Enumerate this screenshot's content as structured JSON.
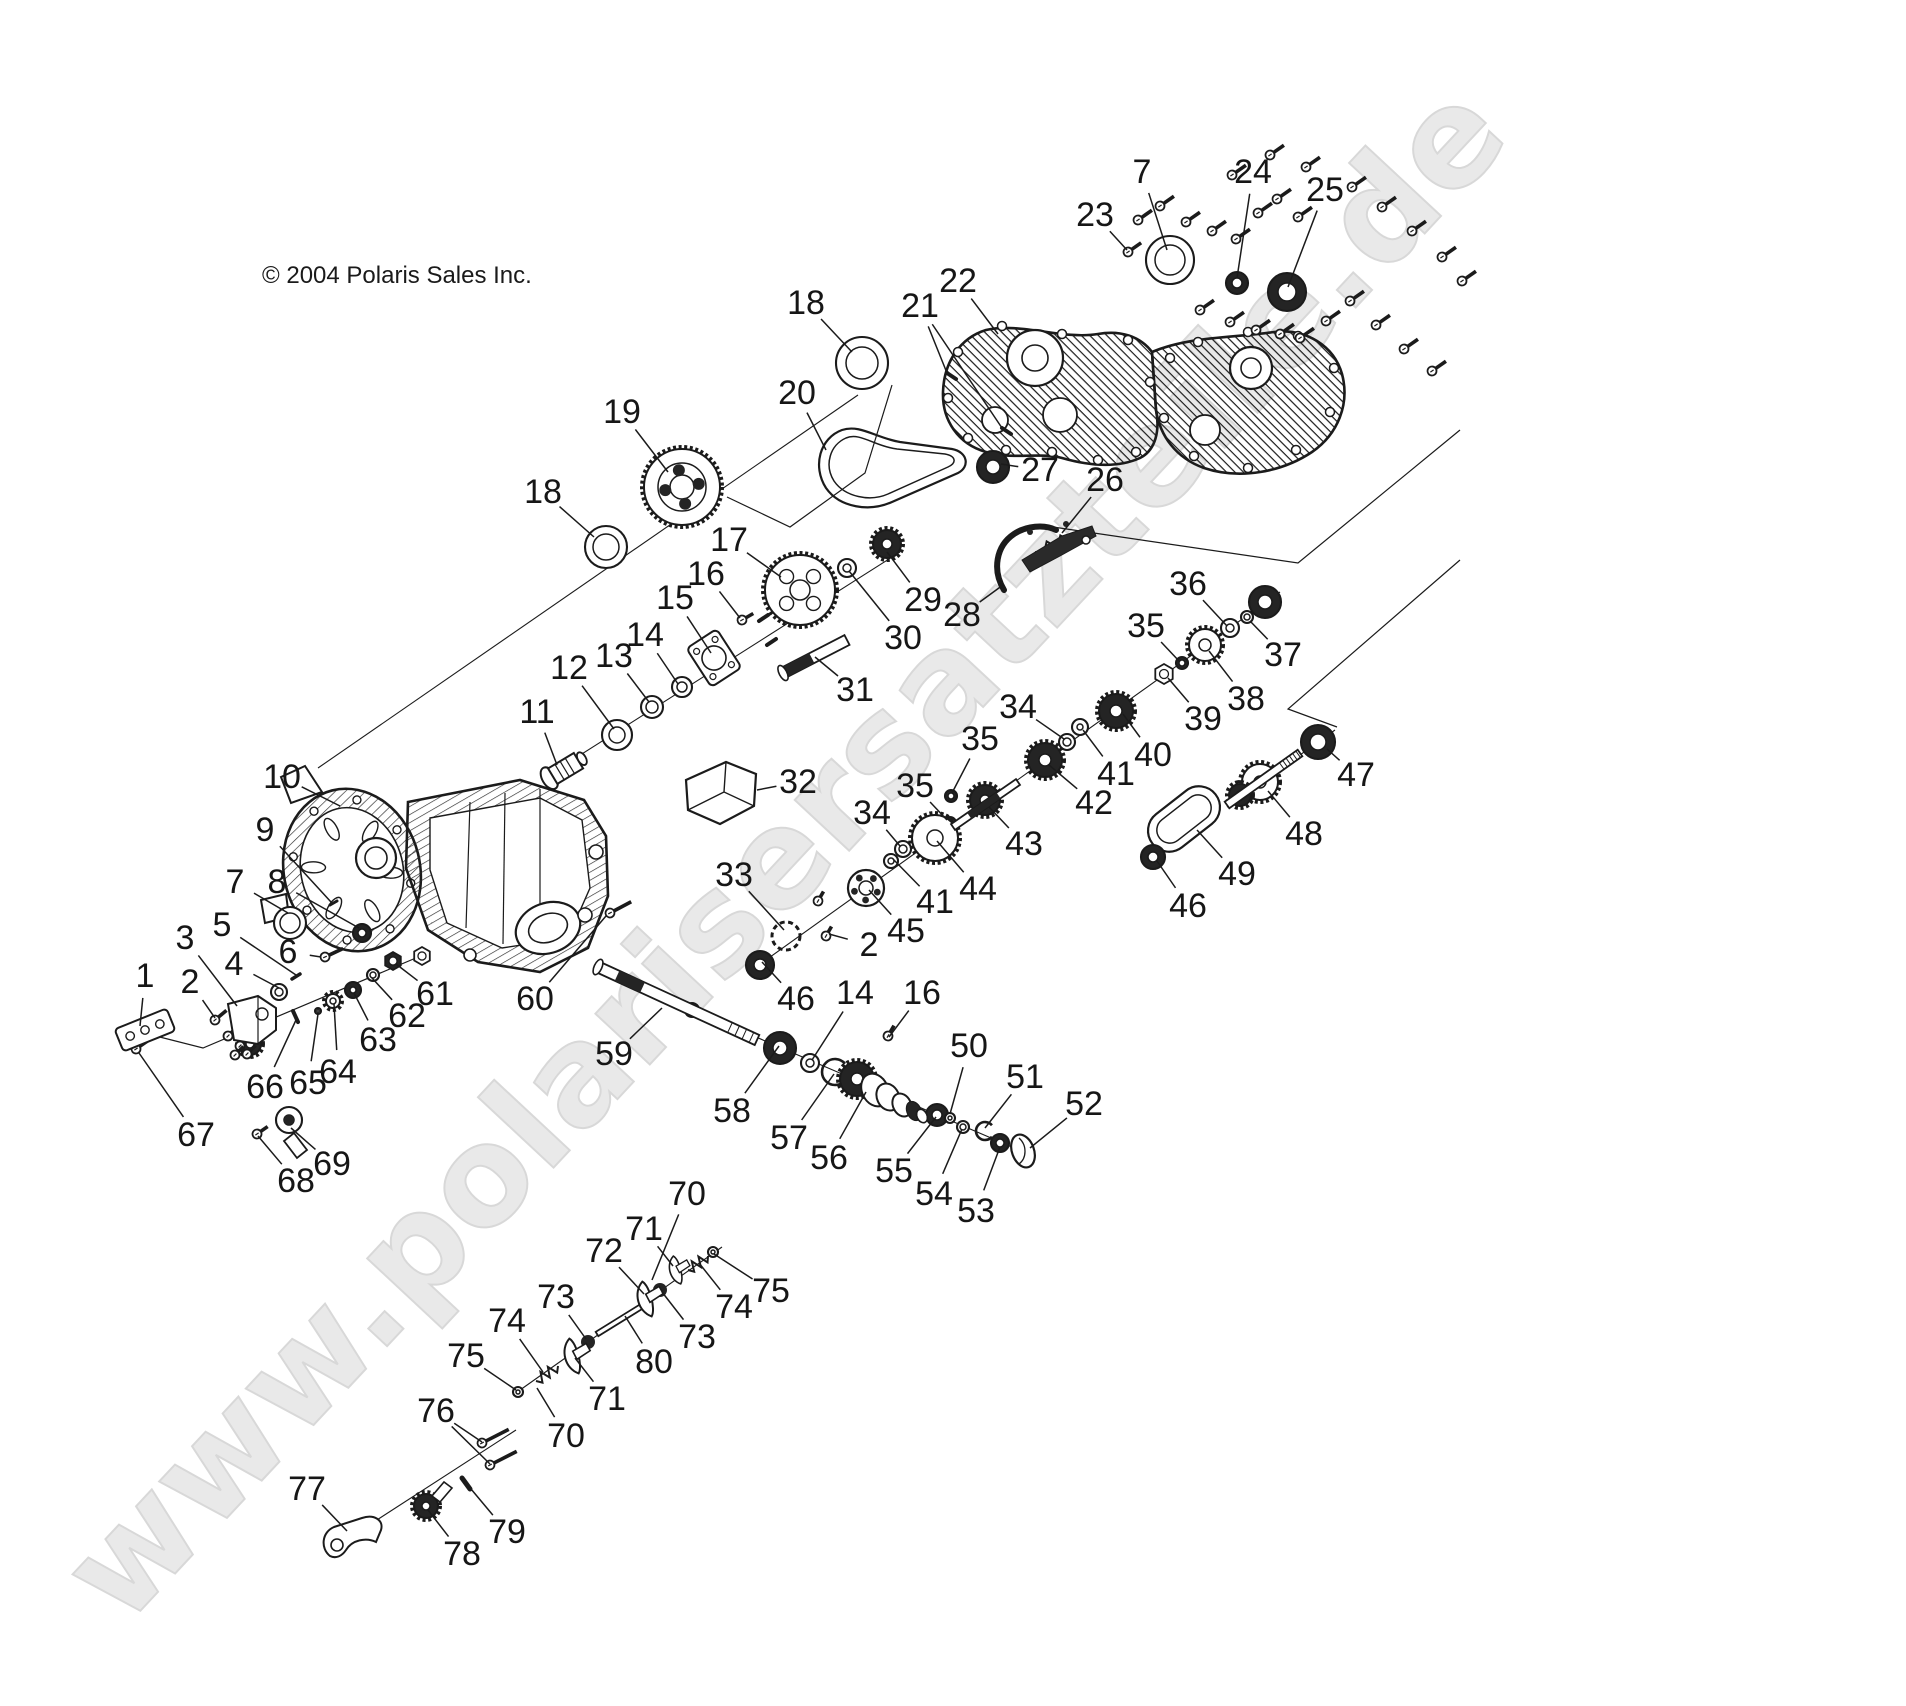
{
  "meta": {
    "copyright": "© 2004 Polaris Sales Inc.",
    "watermark": "www.polarisersatzteile.de",
    "line_color": "#1b1b1b",
    "watermark_color": "#e9e9e9"
  },
  "diagram": {
    "description": "Exploded parts diagram of a Polaris gearcase / transmission assembly",
    "callouts": [
      {
        "n": "1",
        "x": 145,
        "y": 976,
        "tx": 140,
        "ty": 1026
      },
      {
        "n": "2",
        "x": 190,
        "y": 982,
        "tx": 215,
        "ty": 1018
      },
      {
        "n": "3",
        "x": 185,
        "y": 938,
        "tx": 237,
        "ty": 1006
      },
      {
        "n": "4",
        "x": 234,
        "y": 964,
        "tx": 279,
        "ty": 988
      },
      {
        "n": "5",
        "x": 222,
        "y": 925,
        "tx": 296,
        "ty": 975
      },
      {
        "n": "6",
        "x": 288,
        "y": 952,
        "tx": 321,
        "ty": 957
      },
      {
        "n": "7",
        "x": 235,
        "y": 882,
        "tx": 288,
        "ty": 913
      },
      {
        "n": "8",
        "x": 277,
        "y": 882,
        "tx": 359,
        "ty": 928
      },
      {
        "n": "9",
        "x": 265,
        "y": 830,
        "tx": 331,
        "ty": 902
      },
      {
        "n": "10",
        "x": 282,
        "y": 777,
        "tx": 340,
        "ty": 806
      },
      {
        "n": "11",
        "x": 537,
        "y": 712,
        "tx": 557,
        "ty": 765
      },
      {
        "n": "12",
        "x": 569,
        "y": 668,
        "tx": 614,
        "ty": 729
      },
      {
        "n": "13",
        "x": 614,
        "y": 656,
        "tx": 649,
        "ty": 702
      },
      {
        "n": "14",
        "x": 645,
        "y": 635,
        "tx": 678,
        "ty": 684
      },
      {
        "n": "15",
        "x": 675,
        "y": 598,
        "tx": 711,
        "ty": 653
      },
      {
        "n": "16",
        "x": 706,
        "y": 574,
        "tx": 740,
        "ty": 618
      },
      {
        "n": "17",
        "x": 729,
        "y": 540,
        "tx": 781,
        "ty": 577
      },
      {
        "n": "18",
        "x": 806,
        "y": 303,
        "tx": 852,
        "ty": 352
      },
      {
        "n": "18",
        "x": 543,
        "y": 492,
        "tx": 594,
        "ty": 537
      },
      {
        "n": "19",
        "x": 622,
        "y": 412,
        "tx": 668,
        "ty": 472
      },
      {
        "n": "20",
        "x": 797,
        "y": 393,
        "tx": 826,
        "ty": 450
      },
      {
        "n": "21",
        "x": 920,
        "y": 306,
        "tx": 947,
        "ty": 373,
        "tx2": 1002,
        "ty2": 428
      },
      {
        "n": "22",
        "x": 958,
        "y": 281,
        "tx": 998,
        "ty": 334
      },
      {
        "n": "23",
        "x": 1095,
        "y": 215,
        "tx": 1127,
        "ty": 250
      },
      {
        "n": "7",
        "x": 1142,
        "y": 172,
        "tx": 1167,
        "ty": 250
      },
      {
        "n": "24",
        "x": 1253,
        "y": 172,
        "tx": 1237,
        "ty": 278
      },
      {
        "n": "25",
        "x": 1325,
        "y": 190,
        "tx": 1288,
        "ty": 287
      },
      {
        "n": "26",
        "x": 1105,
        "y": 480,
        "tx": 1062,
        "ty": 533
      },
      {
        "n": "27",
        "x": 1040,
        "y": 470,
        "tx": 1001,
        "ty": 464
      },
      {
        "n": "28",
        "x": 962,
        "y": 615,
        "tx": 1003,
        "ty": 585
      },
      {
        "n": "29",
        "x": 923,
        "y": 600,
        "tx": 887,
        "ty": 552
      },
      {
        "n": "30",
        "x": 903,
        "y": 638,
        "tx": 849,
        "ty": 571
      },
      {
        "n": "31",
        "x": 855,
        "y": 690,
        "tx": 815,
        "ty": 657
      },
      {
        "n": "32",
        "x": 798,
        "y": 782,
        "tx": 757,
        "ty": 790
      },
      {
        "n": "33",
        "x": 734,
        "y": 875,
        "tx": 784,
        "ty": 930
      },
      {
        "n": "34",
        "x": 872,
        "y": 813,
        "tx": 900,
        "ty": 846
      },
      {
        "n": "34",
        "x": 1018,
        "y": 707,
        "tx": 1064,
        "ty": 739
      },
      {
        "n": "35",
        "x": 1146,
        "y": 626,
        "tx": 1179,
        "ty": 661
      },
      {
        "n": "35",
        "x": 980,
        "y": 739,
        "tx": 952,
        "ty": 793
      },
      {
        "n": "35",
        "x": 915,
        "y": 786,
        "tx": 947,
        "ty": 820
      },
      {
        "n": "36",
        "x": 1188,
        "y": 584,
        "tx": 1227,
        "ty": 626
      },
      {
        "n": "37",
        "x": 1283,
        "y": 655,
        "tx": 1250,
        "ty": 621
      },
      {
        "n": "38",
        "x": 1246,
        "y": 699,
        "tx": 1209,
        "ty": 651
      },
      {
        "n": "39",
        "x": 1203,
        "y": 719,
        "tx": 1168,
        "ty": 678
      },
      {
        "n": "40",
        "x": 1153,
        "y": 755,
        "tx": 1123,
        "ty": 714
      },
      {
        "n": "41",
        "x": 1116,
        "y": 774,
        "tx": 1083,
        "ty": 730
      },
      {
        "n": "41",
        "x": 935,
        "y": 902,
        "tx": 893,
        "ty": 859
      },
      {
        "n": "42",
        "x": 1094,
        "y": 803,
        "tx": 1049,
        "ty": 765
      },
      {
        "n": "43",
        "x": 1024,
        "y": 844,
        "tx": 989,
        "ty": 807
      },
      {
        "n": "44",
        "x": 978,
        "y": 889,
        "tx": 937,
        "ty": 841
      },
      {
        "n": "45",
        "x": 906,
        "y": 931,
        "tx": 869,
        "ty": 890
      },
      {
        "n": "2",
        "x": 869,
        "y": 945,
        "tx": 829,
        "ty": 934
      },
      {
        "n": "46",
        "x": 796,
        "y": 999,
        "tx": 762,
        "ty": 962
      },
      {
        "n": "46",
        "x": 1188,
        "y": 906,
        "tx": 1157,
        "ty": 861
      },
      {
        "n": "47",
        "x": 1356,
        "y": 775,
        "tx": 1327,
        "ty": 749
      },
      {
        "n": "48",
        "x": 1304,
        "y": 834,
        "tx": 1268,
        "ty": 791
      },
      {
        "n": "49",
        "x": 1237,
        "y": 874,
        "tx": 1197,
        "ty": 830
      },
      {
        "n": "50",
        "x": 969,
        "y": 1046,
        "tx": 950,
        "ty": 1114
      },
      {
        "n": "51",
        "x": 1025,
        "y": 1077,
        "tx": 985,
        "ty": 1128
      },
      {
        "n": "52",
        "x": 1084,
        "y": 1104,
        "tx": 1030,
        "ty": 1148
      },
      {
        "n": "53",
        "x": 976,
        "y": 1211,
        "tx": 1000,
        "ty": 1147
      },
      {
        "n": "54",
        "x": 934,
        "y": 1194,
        "tx": 962,
        "ty": 1129
      },
      {
        "n": "55",
        "x": 894,
        "y": 1171,
        "tx": 936,
        "ty": 1117
      },
      {
        "n": "56",
        "x": 829,
        "y": 1158,
        "tx": 866,
        "ty": 1092
      },
      {
        "n": "57",
        "x": 789,
        "y": 1138,
        "tx": 834,
        "ty": 1074
      },
      {
        "n": "58",
        "x": 732,
        "y": 1111,
        "tx": 779,
        "ty": 1046
      },
      {
        "n": "59",
        "x": 614,
        "y": 1054,
        "tx": 662,
        "ty": 1008
      },
      {
        "n": "60",
        "x": 535,
        "y": 999,
        "tx": 606,
        "ty": 916
      },
      {
        "n": "61",
        "x": 435,
        "y": 994,
        "tx": 396,
        "ty": 964
      },
      {
        "n": "62",
        "x": 407,
        "y": 1016,
        "tx": 372,
        "ty": 978
      },
      {
        "n": "63",
        "x": 378,
        "y": 1040,
        "tx": 354,
        "ty": 993
      },
      {
        "n": "64",
        "x": 338,
        "y": 1072,
        "tx": 334,
        "ty": 1004
      },
      {
        "n": "65",
        "x": 308,
        "y": 1083,
        "tx": 318,
        "ty": 1014
      },
      {
        "n": "66",
        "x": 265,
        "y": 1087,
        "tx": 296,
        "ty": 1020
      },
      {
        "n": "67",
        "x": 196,
        "y": 1135,
        "tx": 139,
        "ty": 1053
      },
      {
        "n": "68",
        "x": 296,
        "y": 1181,
        "tx": 258,
        "ty": 1136
      },
      {
        "n": "69",
        "x": 332,
        "y": 1164,
        "tx": 291,
        "ty": 1128
      },
      {
        "n": "70",
        "x": 566,
        "y": 1436,
        "tx": 537,
        "ty": 1388
      },
      {
        "n": "70",
        "x": 687,
        "y": 1194,
        "tx": 652,
        "ty": 1280
      },
      {
        "n": "71",
        "x": 607,
        "y": 1399,
        "tx": 575,
        "ty": 1358
      },
      {
        "n": "71",
        "x": 644,
        "y": 1229,
        "tx": 673,
        "ty": 1266
      },
      {
        "n": "72",
        "x": 604,
        "y": 1251,
        "tx": 644,
        "ty": 1294
      },
      {
        "n": "73",
        "x": 556,
        "y": 1297,
        "tx": 586,
        "ty": 1339
      },
      {
        "n": "73",
        "x": 697,
        "y": 1337,
        "tx": 662,
        "ty": 1292
      },
      {
        "n": "74",
        "x": 507,
        "y": 1321,
        "tx": 543,
        "ty": 1372
      },
      {
        "n": "74",
        "x": 734,
        "y": 1307,
        "tx": 699,
        "ty": 1263
      },
      {
        "n": "75",
        "x": 466,
        "y": 1356,
        "tx": 516,
        "ty": 1390
      },
      {
        "n": "75",
        "x": 771,
        "y": 1291,
        "tx": 714,
        "ty": 1254
      },
      {
        "n": "76",
        "x": 436,
        "y": 1411,
        "tx": 482,
        "ty": 1442,
        "tx2": 490,
        "ty2": 1464
      },
      {
        "n": "77",
        "x": 307,
        "y": 1489,
        "tx": 347,
        "ty": 1531
      },
      {
        "n": "78",
        "x": 462,
        "y": 1554,
        "tx": 428,
        "ty": 1510
      },
      {
        "n": "79",
        "x": 507,
        "y": 1532,
        "tx": 466,
        "ty": 1483
      },
      {
        "n": "80",
        "x": 654,
        "y": 1362,
        "tx": 625,
        "ty": 1316
      },
      {
        "n": "14",
        "x": 855,
        "y": 993,
        "tx": 812,
        "ty": 1060
      },
      {
        "n": "16",
        "x": 922,
        "y": 993,
        "tx": 889,
        "ty": 1037
      }
    ]
  }
}
